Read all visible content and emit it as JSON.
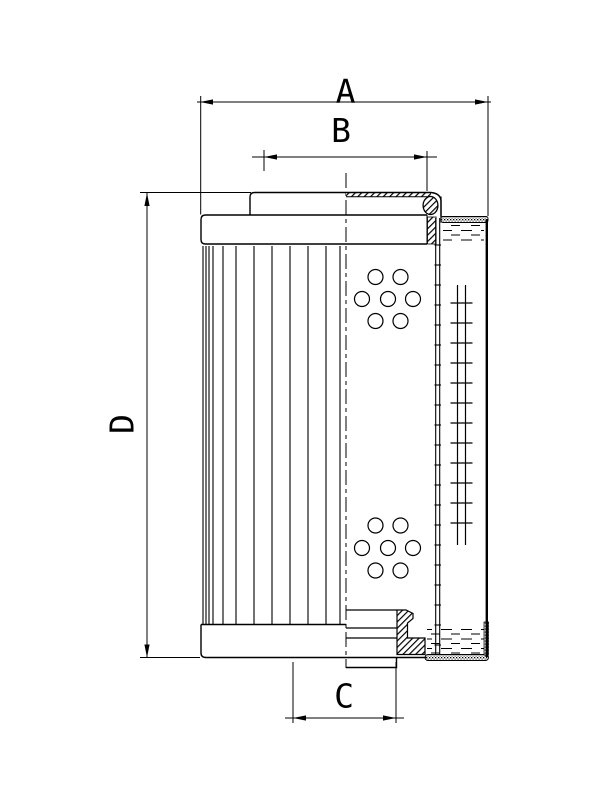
{
  "page": {
    "background": "#ffffff",
    "line_color": "#000000"
  },
  "dimension_labels": {
    "a": "A",
    "b": "B",
    "c": "C",
    "d": "D"
  }
}
